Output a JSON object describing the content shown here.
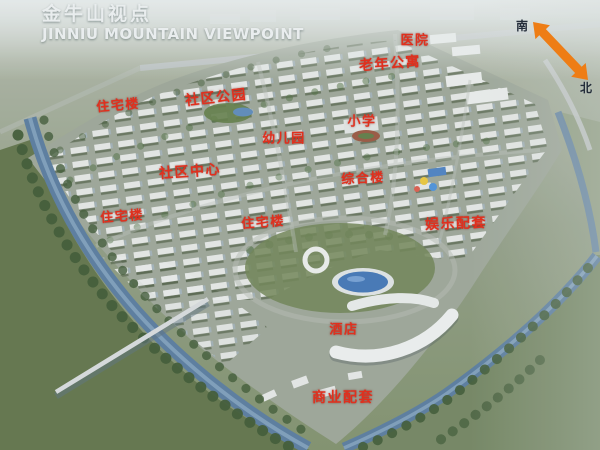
{
  "title": {
    "zh": "金牛山视点",
    "en": "JINNIU MOUNTAIN VIEWPOINT"
  },
  "compass": {
    "south_label": "南",
    "north_label": "北"
  },
  "map_labels": [
    {
      "id": "hospital",
      "text": "医院"
    },
    {
      "id": "senior-apartments",
      "text": "老年公寓"
    },
    {
      "id": "community-park",
      "text": "社区公园"
    },
    {
      "id": "residential-upper-left",
      "text": "住宅楼"
    },
    {
      "id": "primary-school",
      "text": "小学"
    },
    {
      "id": "kindergarten",
      "text": "幼儿园"
    },
    {
      "id": "community-center",
      "text": "社区中心"
    },
    {
      "id": "mixed-use-building",
      "text": "综合楼"
    },
    {
      "id": "residential-mid-left",
      "text": "住宅楼"
    },
    {
      "id": "residential-center",
      "text": "住宅楼"
    },
    {
      "id": "entertainment-facilities",
      "text": "娱乐配套"
    },
    {
      "id": "hotel",
      "text": "酒店"
    },
    {
      "id": "commercial-facilities",
      "text": "商业配套"
    }
  ],
  "colors": {
    "label_red": "#e0301e",
    "title_white": "#e9edee",
    "arrow_orange": "#ee7d15",
    "compass_text": "#242d3a",
    "river_water": "#55799c",
    "lake_blue": "#3f74b4",
    "tree_green": "#3b5632",
    "building_white": "#e7eae9"
  }
}
